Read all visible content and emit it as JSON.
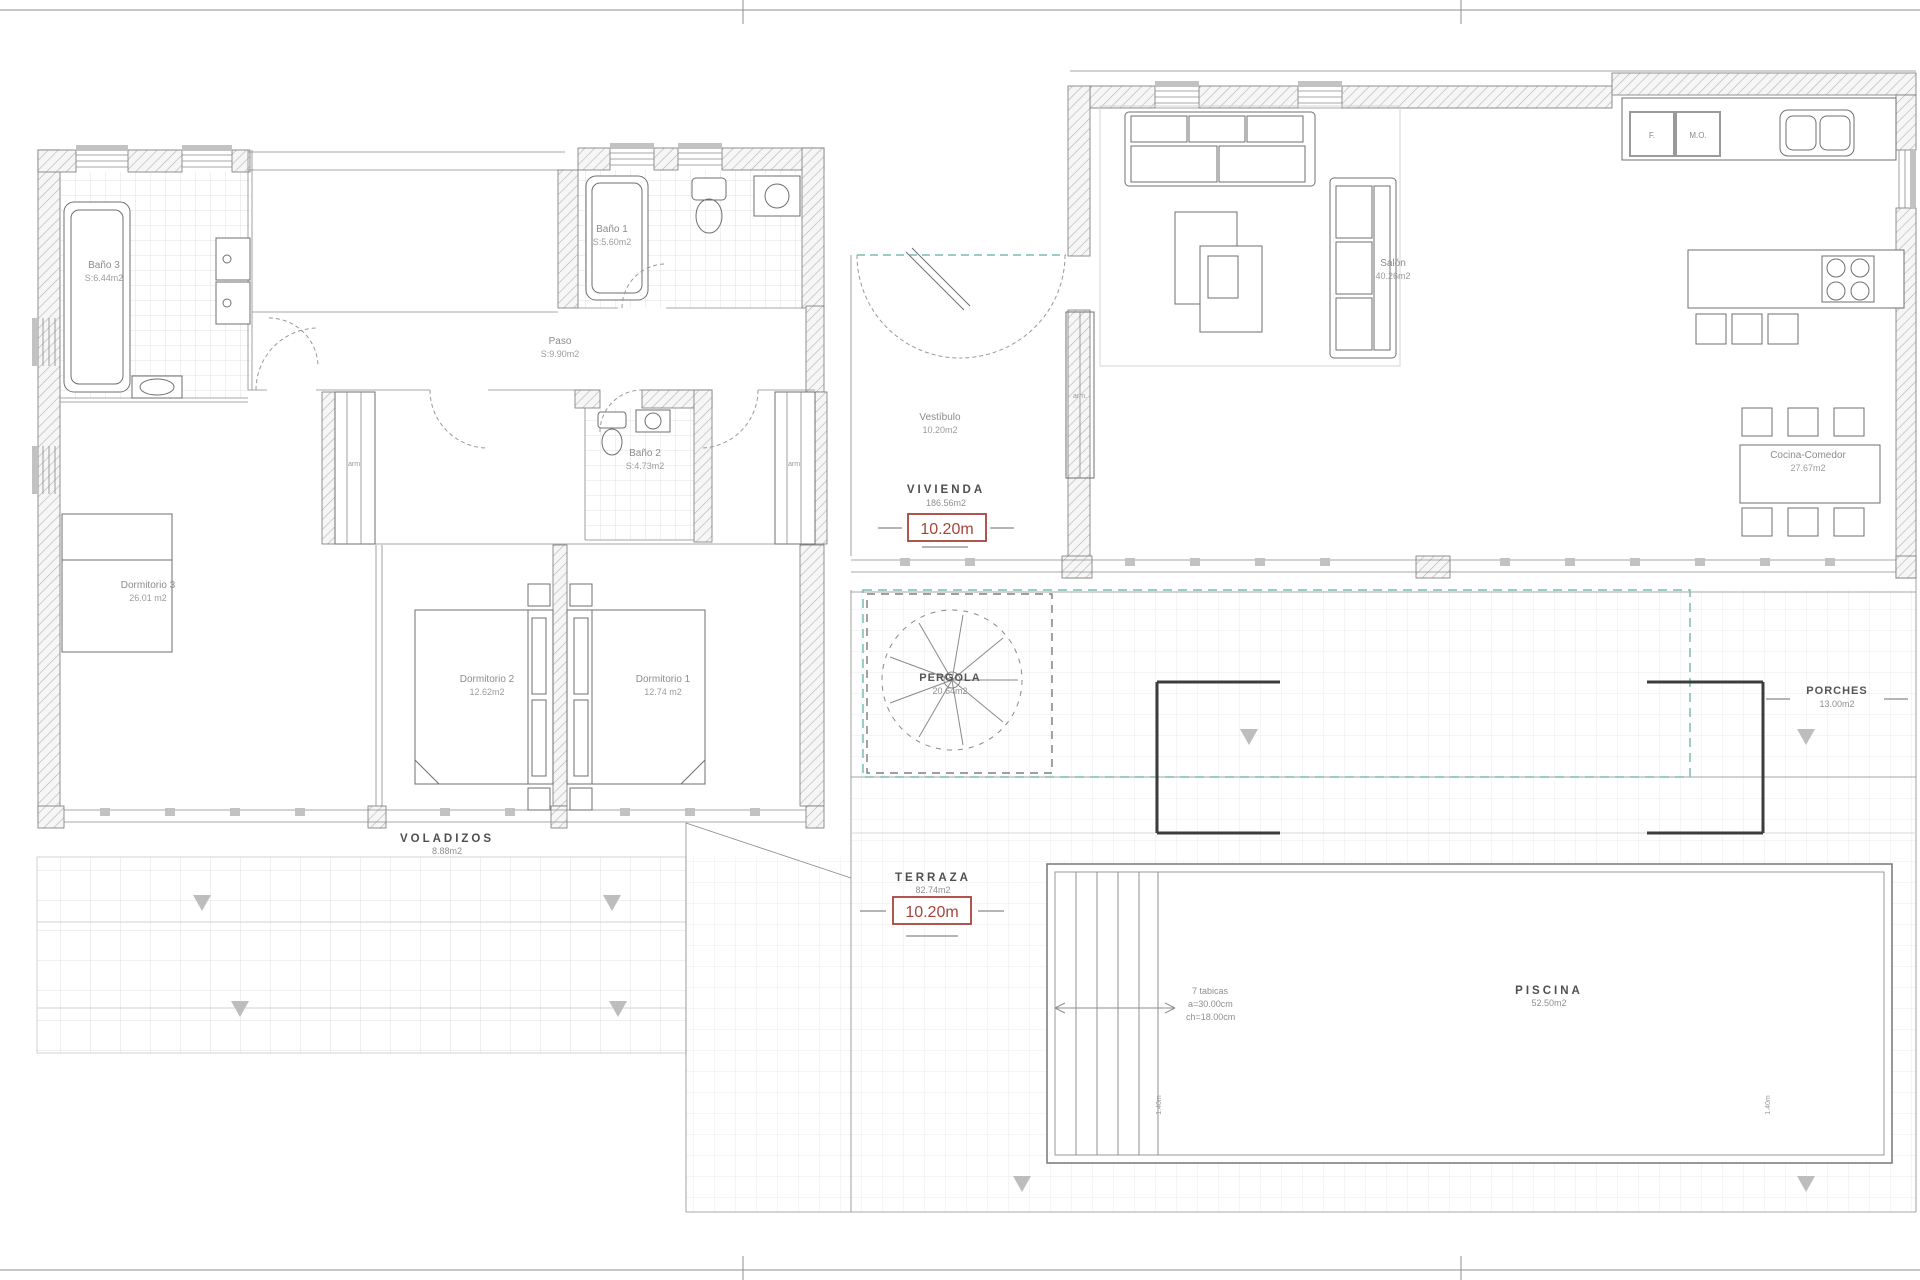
{
  "colors": {
    "dimension_red": "#a8443a",
    "overlay_teal": "#7cbcb5",
    "zone_text": "#4f4f4f",
    "room_text": "#8c8c8c"
  },
  "rooms": {
    "bano3": {
      "name": "Baño 3",
      "area": "S:6.44m2"
    },
    "bano1": {
      "name": "Baño 1",
      "area": "S:5.60m2"
    },
    "paso": {
      "name": "Paso",
      "area": "S:9.90m2"
    },
    "bano2": {
      "name": "Baño 2",
      "area": "S:4.73m2"
    },
    "dormitorio3": {
      "name": "Dormitorio 3",
      "area": "26.01 m2"
    },
    "dormitorio2": {
      "name": "Dormitorio 2",
      "area": "12.62m2"
    },
    "dormitorio1": {
      "name": "Dormitorio 1",
      "area": "12.74 m2"
    },
    "vestibulo": {
      "name": "Vestíbulo",
      "area": "10.20m2"
    },
    "salon": {
      "name": "Salón",
      "area": "40.26m2"
    },
    "cocina_comedor": {
      "name": "Cocina-Comedor",
      "area": "27.67m2"
    }
  },
  "zones": {
    "vivienda": {
      "name": "VIVIENDA",
      "area": "186.56m2",
      "dimension": "10.20m"
    },
    "terraza": {
      "name": "TERRAZA",
      "area": "82.74m2",
      "dimension": "10.20m"
    },
    "pergola": {
      "name": "PERGOLA",
      "area": "20.64m2"
    },
    "porches": {
      "name": "PORCHES",
      "area": "13.00m2"
    },
    "voladizos": {
      "name": "VOLADIZOS",
      "area": "8.88m2"
    },
    "piscina": {
      "name": "PISCINA",
      "area": "52.50m2"
    }
  },
  "annotations": {
    "pool_steps": [
      "7 tabicas",
      "a=30.00cm",
      "ch=18.00cm"
    ],
    "pool_depth_left": "1.40m",
    "pool_depth_right": "1.40m",
    "closet_left": "arm.",
    "closet_right": "arm.",
    "closet_hall": "arm.",
    "fridge": "F.",
    "microwave": "M.O."
  }
}
